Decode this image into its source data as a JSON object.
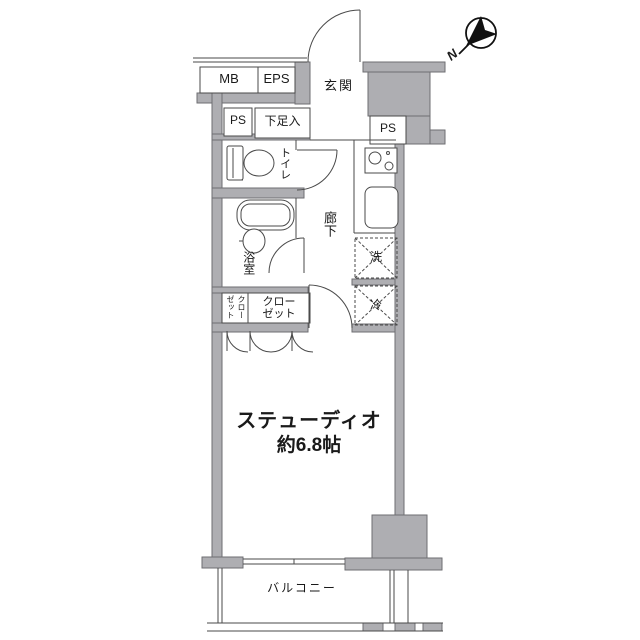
{
  "plan": {
    "type": "floorplan",
    "labels": {
      "mb": "MB",
      "eps": "EPS",
      "ps_left": "PS",
      "shoe_box": "下足入",
      "entrance": "玄関",
      "ps_right": "PS",
      "toilet": "トイレ",
      "hallway": "廊下",
      "bathroom": "浴室",
      "washer": "洗",
      "fridge": "冷",
      "closet_small": "クローゼット",
      "closet_main_line1": "クロー",
      "closet_main_line2": "ゼット",
      "studio_line1": "ステューディオ",
      "studio_line2": "約6.8帖",
      "balcony": "バルコニー",
      "compass_north": "N"
    },
    "colors": {
      "wall_fill": "#aeaeb2",
      "wall_stroke": "#6e6e72",
      "line": "#4a4a4a",
      "background": "#ffffff",
      "text": "#1a1a1a"
    }
  }
}
